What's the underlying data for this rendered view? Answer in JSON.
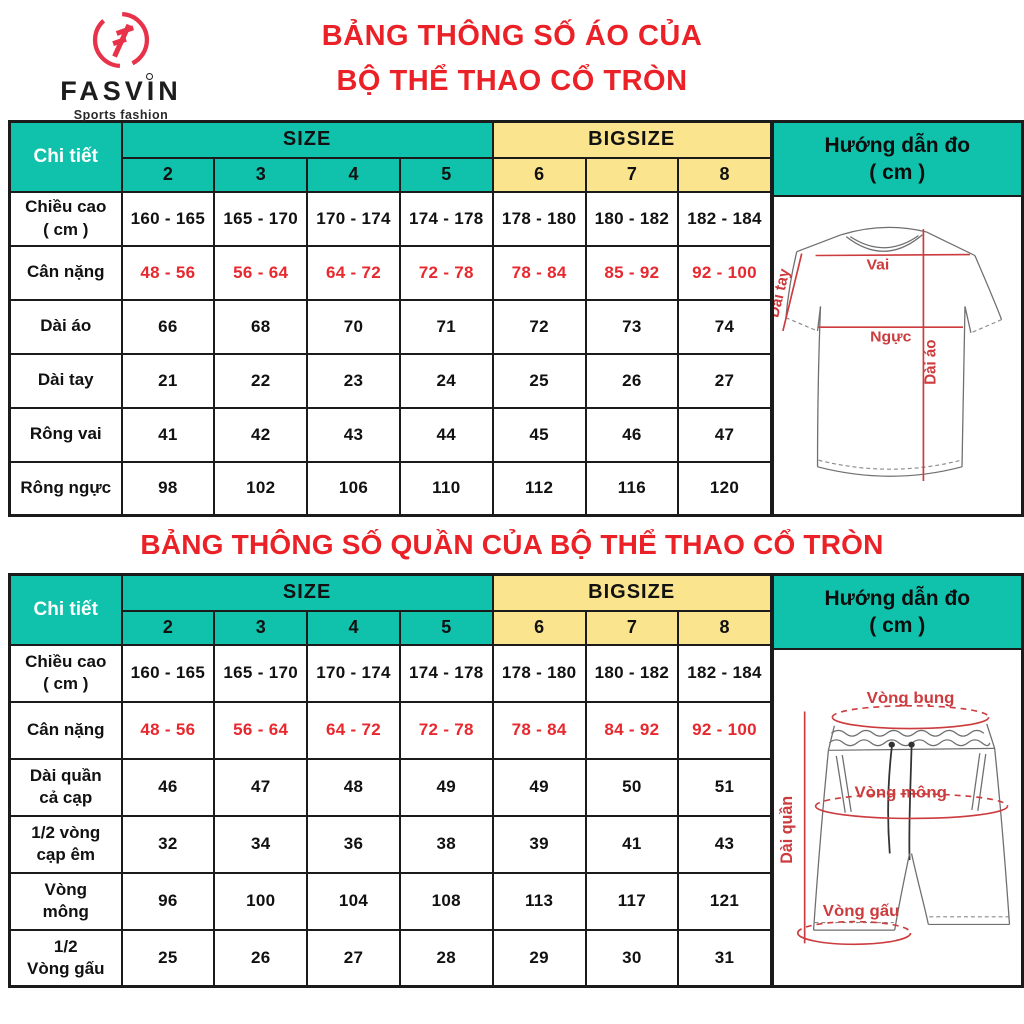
{
  "brand": {
    "name": "FASVIN",
    "tagline": "Sports fashion"
  },
  "colors": {
    "teal": "#10c2ac",
    "yellow": "#fbe48e",
    "title_red": "#ea2127",
    "value_red": "#e8282f",
    "diagram_red": "#cc3b3d",
    "border": "#1b1b1b"
  },
  "shirt_section": {
    "title_line1": "BẢNG THÔNG SỐ ÁO CỦA",
    "title_line2": "BỘ THỂ THAO CỔ TRÒN",
    "table": {
      "corner_label": "Chi tiết",
      "size_label": "SIZE",
      "bigsize_label": "BIGSIZE",
      "size_columns": [
        "2",
        "3",
        "4",
        "5"
      ],
      "bigsize_columns": [
        "6",
        "7",
        "8"
      ],
      "rows": [
        {
          "label": "Chiều cao\n( cm )",
          "red": false,
          "values": [
            "160 - 165",
            "165 - 170",
            "170 - 174",
            "174 - 178",
            "178 - 180",
            "180 - 182",
            "182 - 184"
          ]
        },
        {
          "label": "Cân nặng",
          "red": true,
          "values": [
            "48 - 56",
            "56 - 64",
            "64 - 72",
            "72 - 78",
            "78 - 84",
            "85 - 92",
            "92 - 100"
          ]
        },
        {
          "label": "Dài áo",
          "red": false,
          "values": [
            "66",
            "68",
            "70",
            "71",
            "72",
            "73",
            "74"
          ]
        },
        {
          "label": "Dài tay",
          "red": false,
          "values": [
            "21",
            "22",
            "23",
            "24",
            "25",
            "26",
            "27"
          ]
        },
        {
          "label": "Rông vai",
          "red": false,
          "values": [
            "41",
            "42",
            "43",
            "44",
            "45",
            "46",
            "47"
          ]
        },
        {
          "label": "Rông ngực",
          "red": false,
          "values": [
            "98",
            "102",
            "106",
            "110",
            "112",
            "116",
            "120"
          ]
        }
      ]
    },
    "guide": {
      "header_line1": "Hướng dẫn đo",
      "header_line2": "( cm )",
      "labels": {
        "shoulder": "Vai",
        "chest": "Ngực",
        "shirt_length": "Dài áo",
        "sleeve_length": "Dài tay"
      }
    }
  },
  "pants_section": {
    "title": "BẢNG THÔNG SỐ QUẦN CỦA BỘ THỂ THAO CỔ TRÒN",
    "table": {
      "corner_label": "Chi tiết",
      "size_label": "SIZE",
      "bigsize_label": "BIGSIZE",
      "size_columns": [
        "2",
        "3",
        "4",
        "5"
      ],
      "bigsize_columns": [
        "6",
        "7",
        "8"
      ],
      "rows": [
        {
          "label": "Chiều cao\n( cm )",
          "red": false,
          "values": [
            "160 - 165",
            "165 - 170",
            "170 - 174",
            "174 - 178",
            "178 - 180",
            "180 - 182",
            "182 - 184"
          ]
        },
        {
          "label": "Cân nặng",
          "red": true,
          "values": [
            "48 - 56",
            "56 - 64",
            "64 - 72",
            "72 - 78",
            "78 - 84",
            "84 - 92",
            "92 - 100"
          ]
        },
        {
          "label": "Dài quần\ncả cạp",
          "red": false,
          "values": [
            "46",
            "47",
            "48",
            "49",
            "49",
            "50",
            "51"
          ]
        },
        {
          "label": "1/2 vòng\ncạp êm",
          "red": false,
          "values": [
            "32",
            "34",
            "36",
            "38",
            "39",
            "41",
            "43"
          ]
        },
        {
          "label": "Vòng\nmông",
          "red": false,
          "values": [
            "96",
            "100",
            "104",
            "108",
            "113",
            "117",
            "121"
          ]
        },
        {
          "label": "1/2\nVòng gấu",
          "red": false,
          "values": [
            "25",
            "26",
            "27",
            "28",
            "29",
            "30",
            "31"
          ]
        }
      ]
    },
    "guide": {
      "header_line1": "Hướng dẫn đo",
      "header_line2": "( cm )",
      "labels": {
        "waist": "Vòng bụng",
        "hip": "Vòng mông",
        "pants_length": "Dài quần",
        "hem": "Vòng gấu"
      }
    }
  }
}
